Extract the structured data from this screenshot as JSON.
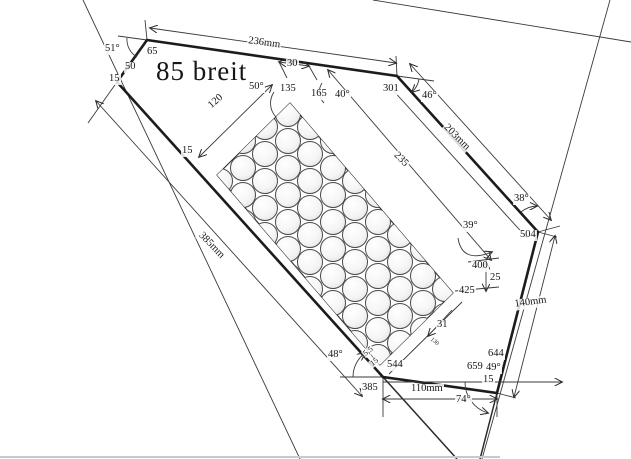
{
  "document": {
    "type": "scanned technical drawing",
    "main_annotation": "85 breit"
  },
  "colors": {
    "line": "#1c1c1c",
    "paper": "#ffffff",
    "scan_edge": "#c9c9c9"
  },
  "drawing": {
    "labels": [
      {
        "text": "51°",
        "x": 104,
        "y": 44
      },
      {
        "text": "65",
        "x": 146,
        "y": 47
      },
      {
        "text": "50",
        "x": 124,
        "y": 62
      },
      {
        "text": "15",
        "x": 108,
        "y": 74
      },
      {
        "text": "85 breit",
        "x": 155,
        "y": 58,
        "size": 27,
        "big": true
      },
      {
        "text": "236mm",
        "x": 248,
        "y": 36,
        "rot": 8
      },
      {
        "text": "30",
        "x": 286,
        "y": 59
      },
      {
        "text": "50°",
        "x": 248,
        "y": 82
      },
      {
        "text": "135",
        "x": 279,
        "y": 84
      },
      {
        "text": "165",
        "x": 310,
        "y": 89
      },
      {
        "text": "40°",
        "x": 334,
        "y": 90
      },
      {
        "text": "301",
        "x": 382,
        "y": 84
      },
      {
        "text": "46°",
        "x": 421,
        "y": 91
      },
      {
        "text": "203mm",
        "x": 448,
        "y": 122,
        "rot": 45
      },
      {
        "text": "120",
        "x": 206,
        "y": 104,
        "rot": -42
      },
      {
        "text": "15",
        "x": 181,
        "y": 146
      },
      {
        "text": "235",
        "x": 398,
        "y": 150,
        "rot": 45
      },
      {
        "text": "385mm",
        "x": 203,
        "y": 230,
        "rot": 46
      },
      {
        "text": "38°",
        "x": 513,
        "y": 194
      },
      {
        "text": "504",
        "x": 519,
        "y": 230
      },
      {
        "text": "39°",
        "x": 462,
        "y": 221
      },
      {
        "text": "400",
        "x": 471,
        "y": 261
      },
      {
        "text": "25",
        "x": 489,
        "y": 273
      },
      {
        "text": "425",
        "x": 458,
        "y": 286
      },
      {
        "text": "31",
        "x": 436,
        "y": 320
      },
      {
        "text": "130",
        "x": 432,
        "y": 336,
        "size": 6,
        "rot": 40
      },
      {
        "text": "48°",
        "x": 327,
        "y": 350
      },
      {
        "text": "5,5",
        "x": 361,
        "y": 352,
        "size": 8,
        "rot": -38
      },
      {
        "text": "15",
        "x": 368,
        "y": 362,
        "size": 8,
        "rot": -38
      },
      {
        "text": "544",
        "x": 386,
        "y": 360
      },
      {
        "text": "385",
        "x": 361,
        "y": 383
      },
      {
        "text": "110mm",
        "x": 410,
        "y": 384
      },
      {
        "text": "74°",
        "x": 455,
        "y": 395
      },
      {
        "text": "659",
        "x": 466,
        "y": 362
      },
      {
        "text": "49°",
        "x": 485,
        "y": 363
      },
      {
        "text": "15",
        "x": 482,
        "y": 375
      },
      {
        "text": "644",
        "x": 487,
        "y": 349
      },
      {
        "text": "140mm",
        "x": 513,
        "y": 300,
        "rot": -8
      }
    ],
    "hole_grid": {
      "x0": 220,
      "y0": 100,
      "cols": 12,
      "rows": 11,
      "col_spacing": 22.5,
      "row_spacing": 27,
      "stagger": 13.5,
      "diameter": 26,
      "clip": [
        [
          290,
          103
        ],
        [
          453,
          293
        ],
        [
          380,
          365
        ],
        [
          217,
          175
        ]
      ]
    }
  }
}
